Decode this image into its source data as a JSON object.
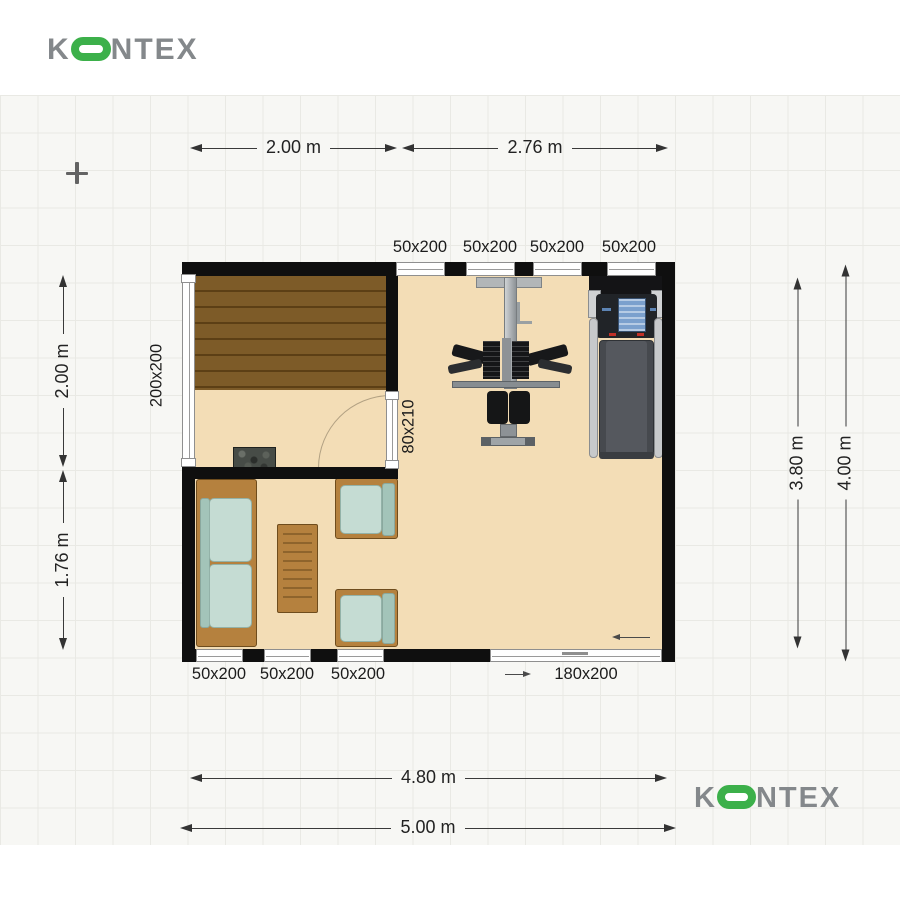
{
  "brand": {
    "top_logo": {
      "pre": "K",
      "post": "NTEX"
    },
    "bottom_logo": {
      "pre": "K",
      "post": "NTEX"
    },
    "gray": "#84888b",
    "green": "#3cb04a"
  },
  "dims": {
    "top": [
      "2.00 m",
      "2.76 m"
    ],
    "left": [
      "2.00 m",
      "1.76 m"
    ],
    "right": [
      "3.80 m",
      "4.00 m"
    ],
    "bottom": [
      "4.80 m",
      "5.00 m"
    ]
  },
  "openings": {
    "top_windows": [
      "50x200",
      "50x200",
      "50x200",
      "50x200"
    ],
    "bottom_windows": [
      "50x200",
      "50x200",
      "50x200"
    ],
    "left_window": "200x200",
    "interior_door": "80x210",
    "sliding_door": "180x200"
  },
  "colors": {
    "floor": "#f3ddb6",
    "wall": "#0f0f0f",
    "sauna_wood": "#7b5827",
    "sofa_cushion": "#c5dcd3",
    "frame_wood": "#b5813e"
  }
}
